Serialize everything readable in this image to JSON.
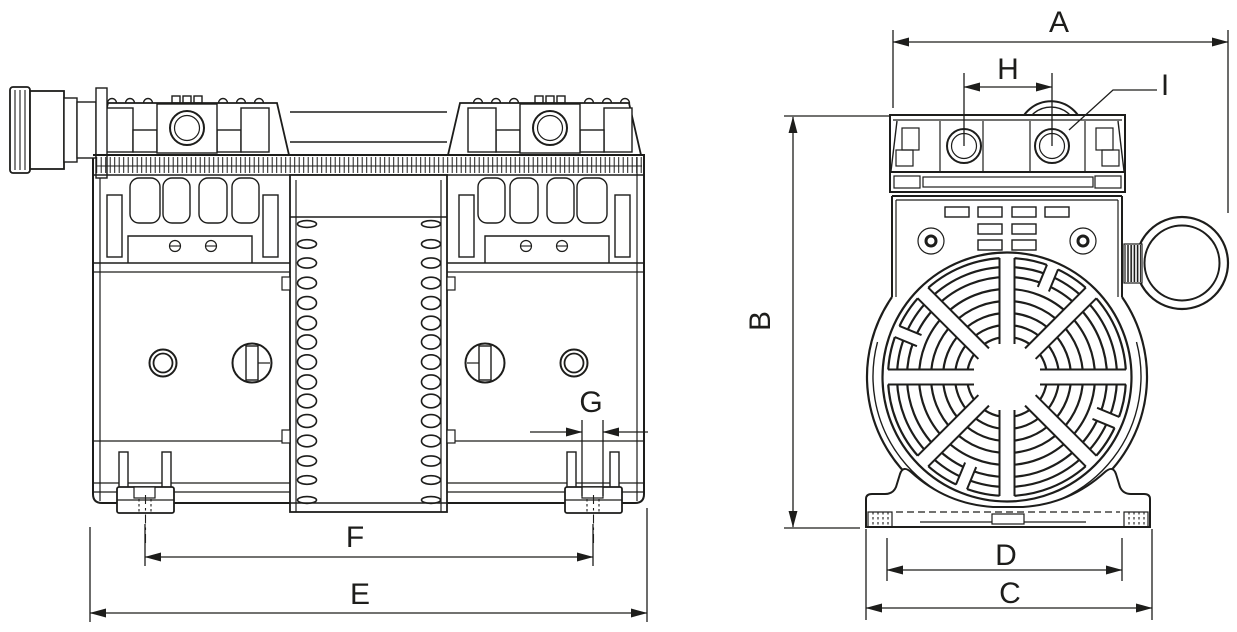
{
  "drawing": {
    "background": "#ffffff",
    "line_color": "#1d1d1b",
    "dimension_labels": {
      "A": "A",
      "B": "B",
      "C": "C",
      "D": "D",
      "E": "E",
      "F": "F",
      "G": "G",
      "H": "H",
      "I": "I"
    }
  }
}
